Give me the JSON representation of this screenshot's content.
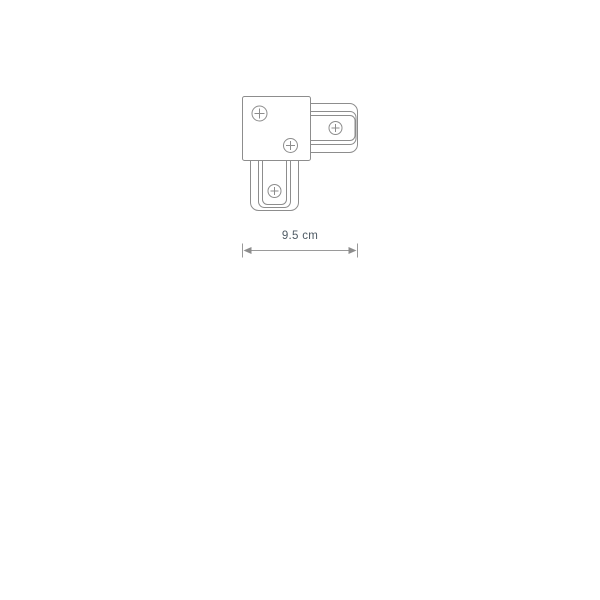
{
  "page": {
    "background": "#ffffff"
  },
  "colors": {
    "line": "#8d8d8d",
    "dimension_line": "#9a9a9a",
    "text": "#4e5a64"
  },
  "drawing": {
    "subject": "L-connector technical drawing",
    "screw_icon_count": 4,
    "dimension": {
      "label": "9.5 cm"
    }
  },
  "icons": {
    "screw": "circle-with-plus",
    "arrow_left": "filled-triangle-left",
    "arrow_right": "filled-triangle-right"
  }
}
